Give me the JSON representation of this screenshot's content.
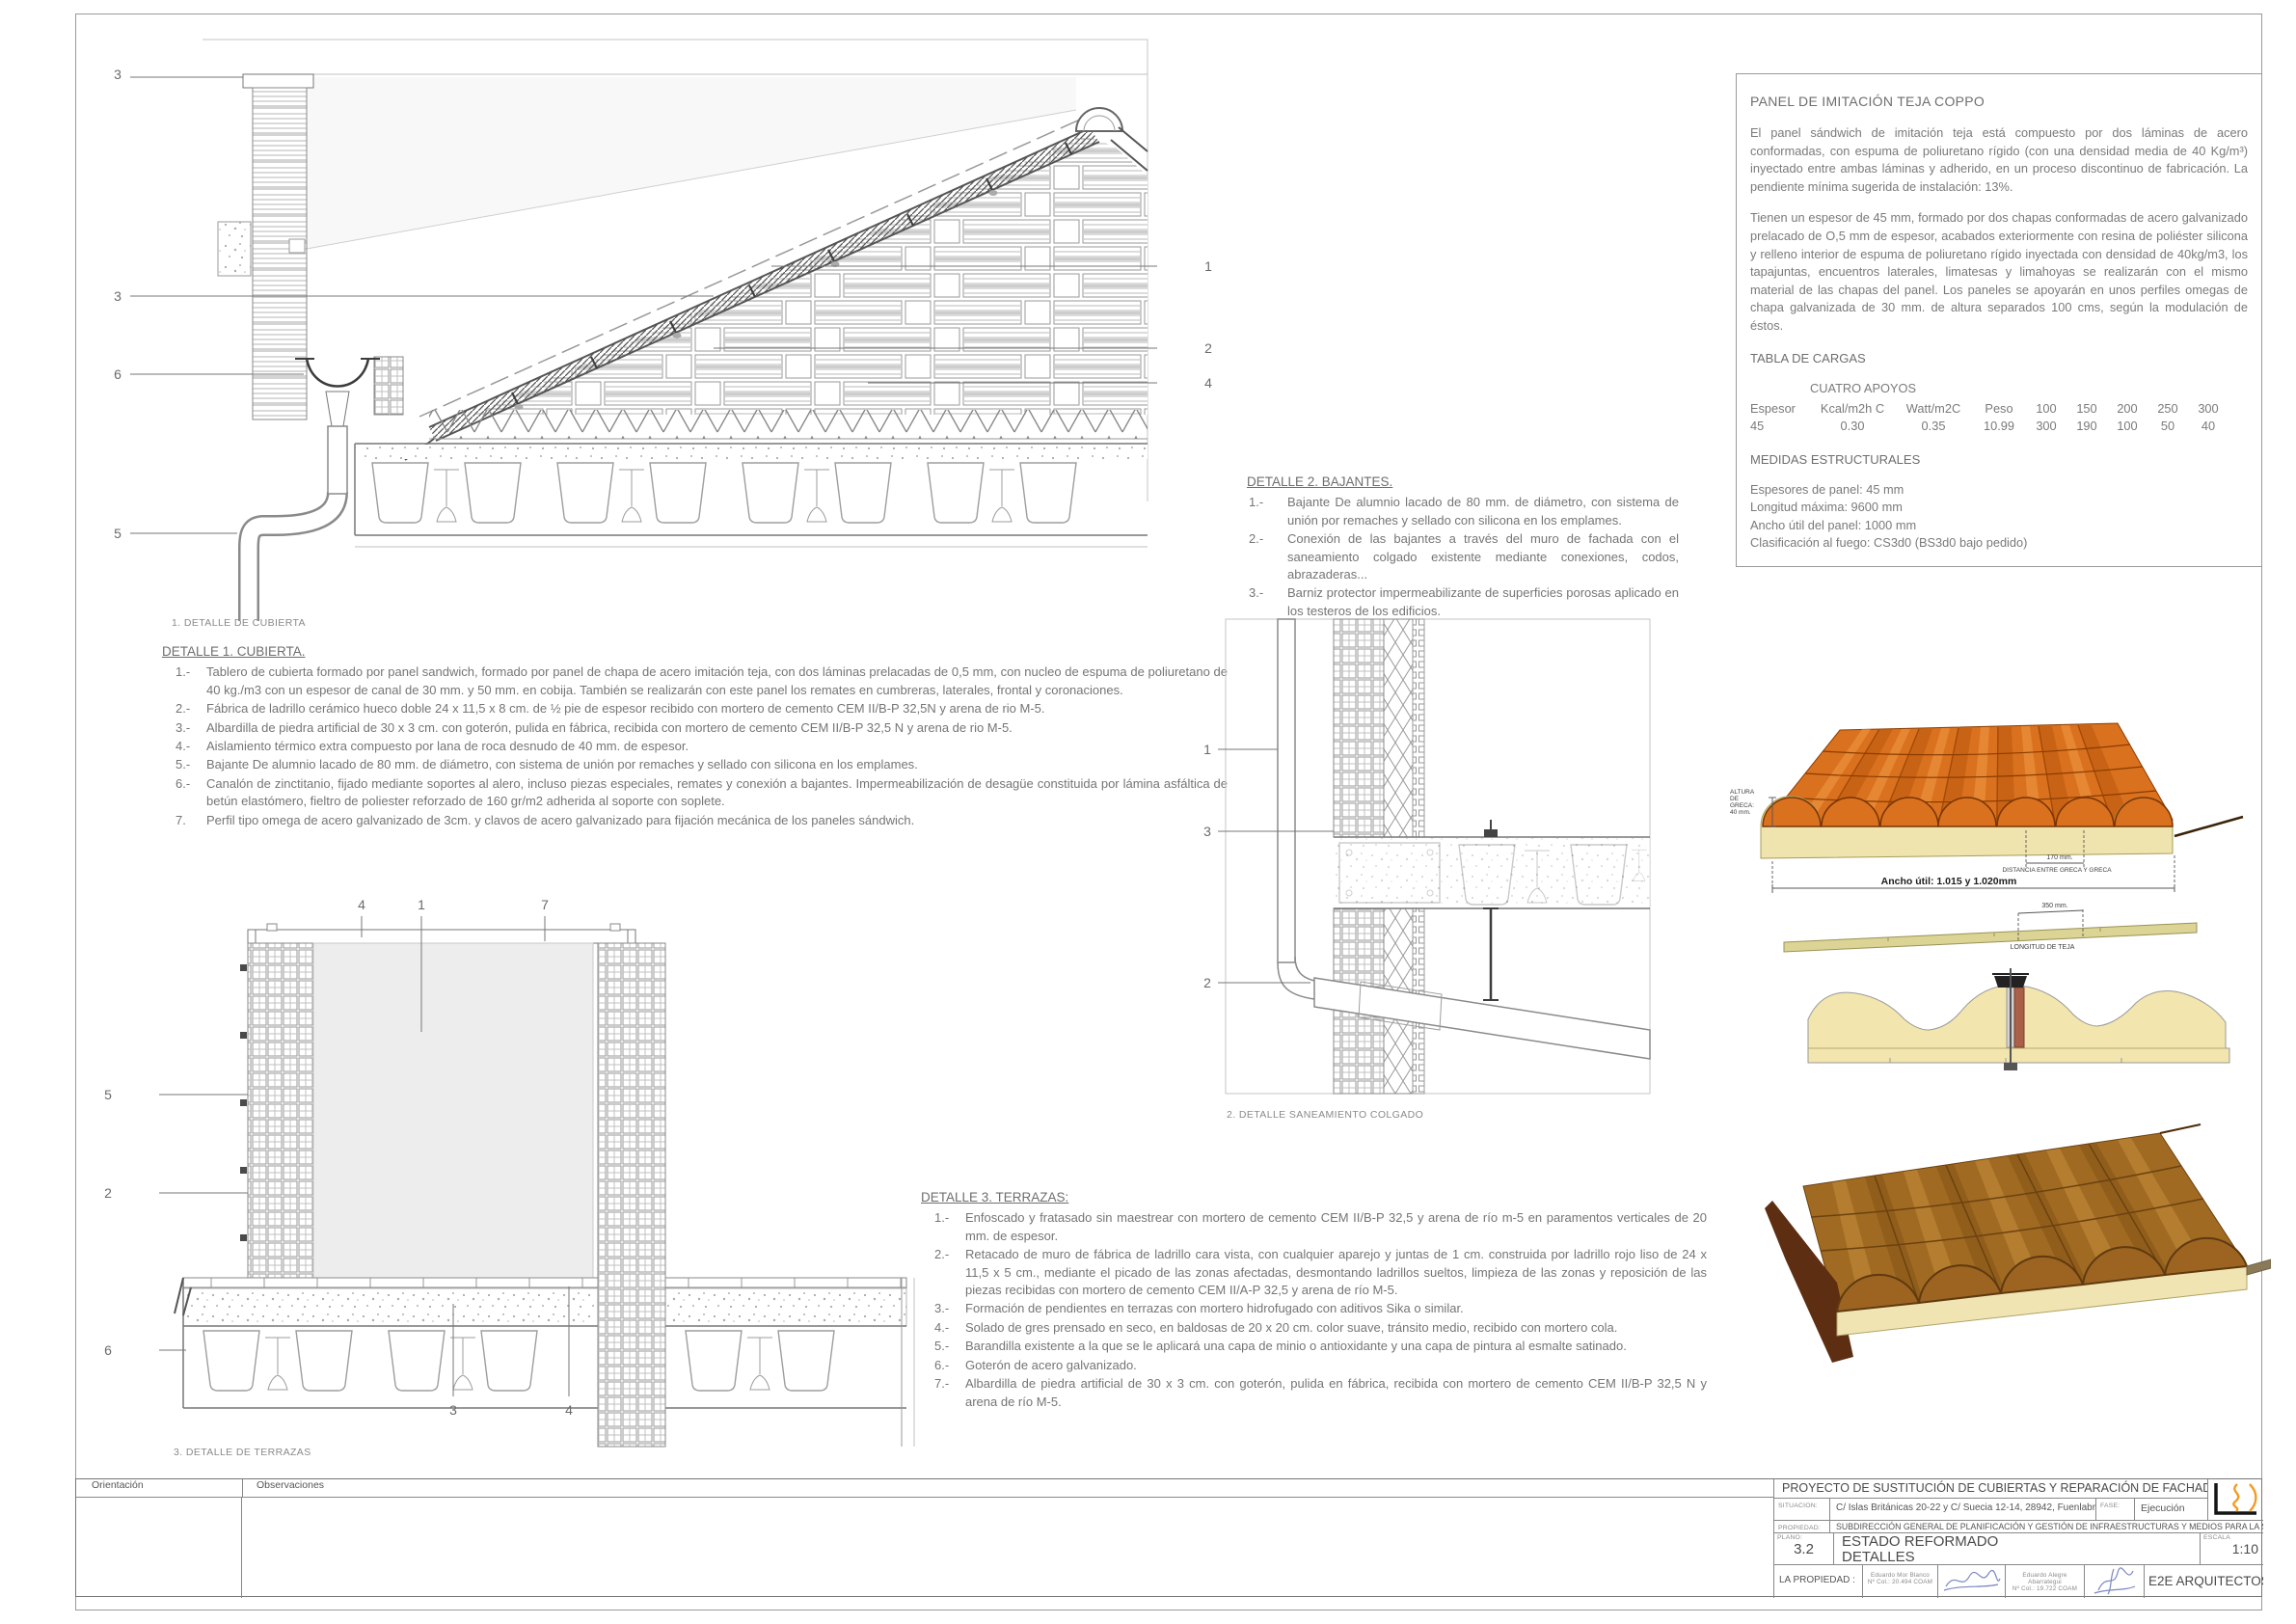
{
  "panel_info": {
    "title": "PANEL DE IMITACIÓN TEJA COPPO",
    "paragraph1": "El panel sándwich de imitación teja está compuesto por dos láminas de acero conformadas, con espuma de poliuretano rígido (con una densidad media de 40 Kg/m³) inyectado entre ambas láminas y adherido, en un proceso discontinuo de fabricación. La pendiente mínima sugerida de instalación: 13%.",
    "paragraph2": "Tienen un espesor de 45 mm, formado por dos chapas conformadas de acero galvanizado prelacado de O,5 mm de espesor, acabados exteriormente con resina de poliéster silicona y relleno interior de espuma de poliuretano rígido inyectada con densidad de 40kg/m3, los tapajuntas, encuentros laterales, limatesas y limahoyas se realizarán con el mismo material de las chapas del panel. Los paneles se apoyarán en unos perfiles omegas de chapa galvanizada de 30 mm. de altura separados 100 cms, según la modulación de éstos.",
    "tabla_cargas": {
      "title": "TABLA DE CARGAS",
      "subtitle": "CUATRO APOYOS",
      "headers": [
        "Espesor",
        "Kcal/m2h C",
        "Watt/m2C",
        "Peso",
        "100",
        "150",
        "200",
        "250",
        "300"
      ],
      "row": [
        "45",
        "0.30",
        "0.35",
        "10.99",
        "300",
        "190",
        "100",
        "50",
        "40"
      ]
    },
    "medidas": {
      "title": "MEDIDAS ESTRUCTURALES",
      "lines": [
        "Espesores de panel: 45 mm",
        "Longitud máxima: 9600 mm",
        "Ancho útil del panel: 1000 mm",
        "Clasificación al fuego: CS3d0 (BS3d0 bajo pedido)"
      ]
    }
  },
  "detalle1": {
    "title": "DETALLE 1. CUBIERTA.",
    "items": [
      {
        "num": "1.-",
        "text": "Tablero de cubierta formado por panel sandwich, formado por panel de chapa de acero imitación teja, con dos láminas prelacadas de 0,5 mm, con nucleo de espuma de poliuretano de 40 kg./m3 con un espesor de canal de 30 mm. y 50 mm. en cobija. También se realizarán con este panel los remates en cumbreras, laterales, frontal y coronaciones."
      },
      {
        "num": "2.-",
        "text": "Fábrica de ladrillo cerámico hueco doble 24 x 11,5 x 8 cm. de ½ pie de espesor recibido con mortero de cemento CEM II/B-P 32,5N y arena de rio M-5."
      },
      {
        "num": "3.-",
        "text": "Albardilla de piedra artificial de 30 x 3 cm. con goterón, pulida en fábrica, recibida con mortero de cemento CEM II/B-P 32,5 N y  arena de rio M-5."
      },
      {
        "num": "4.-",
        "text": "Aislamiento térmico extra compuesto por lana de roca desnudo de 40 mm. de espesor."
      },
      {
        "num": "5.-",
        "text": "Bajante De alumnio lacado de 80 mm. de diámetro, con sistema de unión por remaches y sellado con silicona en los emplames."
      },
      {
        "num": "6.-",
        "text": "Canalón de zinctitanio, fijado mediante soportes al alero, incluso piezas especiales, remates y conexión a bajantes. Impermeabilización de desagüe constituida por lámina asfáltica de betún elastómero, fieltro de poliester reforzado de    160 gr/m2 adherida al soporte con soplete."
      },
      {
        "num": "7.",
        "text": "Perfil tipo omega de acero galvanizado de 3cm. y clavos de acero galvanizado para fijación mecánica de los paneles sándwich."
      }
    ]
  },
  "detalle2": {
    "title": "DETALLE 2. BAJANTES.",
    "items": [
      {
        "num": "1.-",
        "text": "Bajante De alumnio lacado de 80 mm. de diámetro, con sistema de unión por remaches y sellado con silicona en los emplames."
      },
      {
        "num": "2.-",
        "text": "Conexión de las bajantes a través del muro de fachada con el saneamiento colgado existente mediante conexiones, codos, abrazaderas..."
      },
      {
        "num": "3.-",
        "text": "Barniz protector impermeabilizante de superficies porosas aplicado en los testeros de los edificios."
      }
    ]
  },
  "detalle3": {
    "title": "DETALLE 3. TERRAZAS:",
    "items": [
      {
        "num": "1.-",
        "text": "Enfoscado y fratasado sin maestrear con mortero de cemento CEM II/B-P 32,5 y arena de río m-5 en paramentos verticales de 20 mm. de espesor."
      },
      {
        "num": "2.-",
        "text": "Retacado de muro de fábrica de ladrillo cara vista, con cualquier aparejo y juntas de 1 cm. construida por ladrillo rojo liso de 24 x 11,5 x 5 cm., mediante el picado de las zonas afectadas, desmontando ladrillos sueltos, limpieza de las zonas y reposición de las piezas recibidas con mortero de cemento CEM II/A-P 32,5 y arena de río M-5."
      },
      {
        "num": "3.-",
        "text": "Formación de pendientes en terrazas con mortero hidrofugado con aditivos Sika o similar."
      },
      {
        "num": "4.-",
        "text": "Solado de gres prensado en seco, en baldosas de 20 x 20 cm. color suave, tránsito medio, recibido con mortero cola."
      },
      {
        "num": "5.-",
        "text": "Barandilla existente a la que se le aplicará una capa de minio o antioxidante y una capa de pintura al esmalte satinado."
      },
      {
        "num": "6.-",
        "text": "Goterón de acero galvanizado."
      },
      {
        "num": "7.-",
        "text": "Albardilla de piedra artificial de 30 x 3 cm. con goterón, pulida en fábrica, recibida con mortero de cemento CEM II/B-P 32,5 N y arena de río M-5."
      }
    ]
  },
  "captions": {
    "d1": "1. DETALLE DE CUBIERTA",
    "d2": "2. DETALLE SANEAMIENTO COLGADO",
    "d3": "3. DETALLE DE TERRAZAS"
  },
  "callouts": {
    "d1_left": [
      "3",
      "3",
      "6",
      "5"
    ],
    "d1_right": [
      "1",
      "2",
      "4"
    ],
    "d2": [
      "1",
      "3",
      "2"
    ],
    "d3_top": [
      "4",
      "1",
      "7"
    ],
    "d3_left": [
      "5",
      "2",
      "6"
    ],
    "d3_bottom": [
      "3",
      "4"
    ]
  },
  "render_annotations": {
    "altura_greca": "ALTURA\nDE\nGRECA:\n40 mm.",
    "dim_170": "170 mm.",
    "dist_greca": "DISTANCIA ENTRE GRECA Y GRECA",
    "ancho_util": "Ancho útil: 1.015 y 1.020mm",
    "dim_350": "350 mm.",
    "longitud_teja": "LONGITUD DE TEJA"
  },
  "title_block": {
    "orientacion": "Orientación",
    "observaciones": "Observaciones",
    "project_title": "PROYECTO DE SUSTITUCIÓN DE CUBIERTAS Y REPARACIÓN DE FACHADAS",
    "situacion_label": "SITUACION:",
    "situacion_value": "C/ Islas Británicas 20-22 y C/ Suecia 12-14, 28942, Fuenlabrada (Madrid)",
    "fase_label": "FASE:",
    "fase_value": "Ejecución",
    "propiedad_label": "PROPIEDAD:",
    "propiedad_value": "SUBDIRECCIÓN GENERAL DE PLANIFICACIÓN Y GESTIÓN DE INFRAESTRUCTURAS Y MEDIOS PARA LA SEGURIDAD",
    "plano_label": "PLANO:",
    "plano_num": "3.2",
    "plano_title1": "ESTADO REFORMADO",
    "plano_title2": "DETALLES",
    "escala_label": "ESCALA",
    "escala_value": "1:10",
    "la_propiedad_label": "LA PROPIEDAD :",
    "arch1_name": "Eduardo Mor Blanco",
    "arch1_col": "Nº Col.: 20.494 COAM",
    "arch2_name": "Eduardo Alegre Abarrategui",
    "arch2_col": "Nº Col.: 19.722 COAM",
    "firm": "E2E ARQUITECTOS"
  },
  "colors": {
    "line_gray": "#8a8a8a",
    "tile_orange": "#d9711f",
    "tile_brown": "#a06a22",
    "foam_cream": "#efe3ae",
    "logo_orange": "#f59a23",
    "signature_blue": "#7b86c2"
  }
}
